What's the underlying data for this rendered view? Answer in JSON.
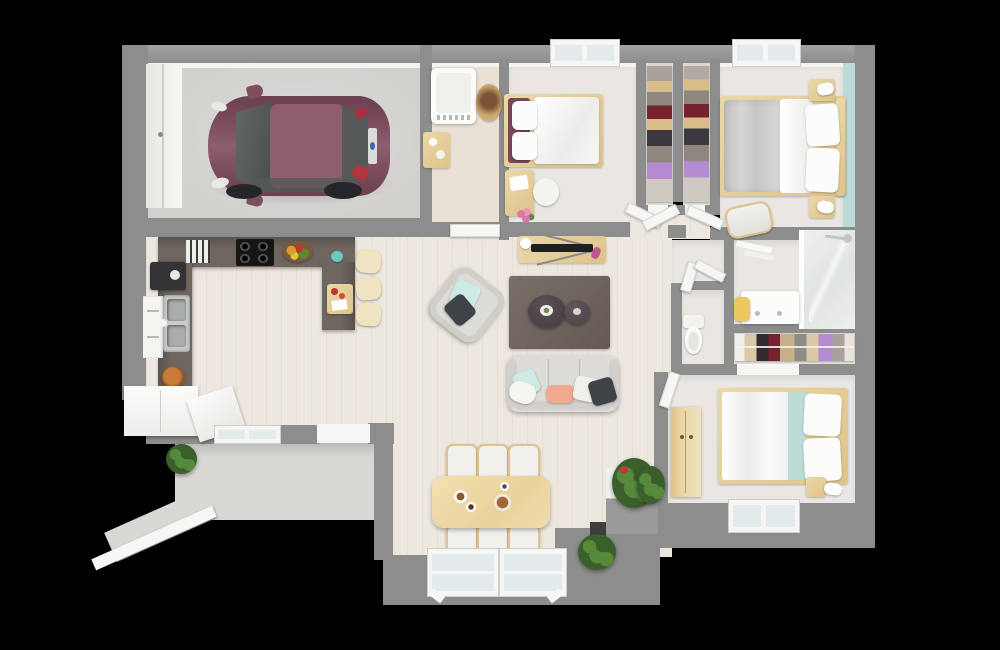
{
  "scene": {
    "title": "3D top-down floor plan render of a single-story house",
    "view": "overhead 3D render on black background"
  },
  "palette": {
    "wall": "#8d8d8d",
    "wall_light": "#a2a2a2",
    "wall_face": "#f3f3f1",
    "floor_wood": "#ece7df",
    "floor_light": "#eae7e2",
    "floor_laundry": "#e9e1d4",
    "concrete": "#d2d1ce",
    "porch": "#d9d8d4",
    "counter": "#6f6660",
    "counter_dark": "#5a524d",
    "wood": "#ead7a9",
    "wood_mid": "#dfc38a",
    "car_body": "#7d4e5e",
    "car_roof": "#8d5e6d",
    "car_glass": "#545a58",
    "rug": "#6e645d",
    "table_dark": "#4a4147",
    "sofa": "#dedcd8",
    "teal": "#bcdad6",
    "pillow_teal": "#cdeae4",
    "coral": "#f2a88d",
    "charcoal": "#3f4347",
    "green": "#558a3c",
    "green_dark": "#3a5f2b",
    "white": "#f6f6f4",
    "glass_blue": "#e3ebec",
    "clothes_red": "#76222e",
    "clothes_purple": "#b48bd0",
    "yellow": "#ecc95c",
    "pink": "#d978a8",
    "steel": "#c9cbc9",
    "tv_black": "#1d1f22",
    "basket_orange": "#c97a3a"
  },
  "rooms": {
    "garage": "Garage",
    "laundry": "Laundry room",
    "bedroom1": "Bedroom 1",
    "closet": "Walk-in closet",
    "master_bedroom": "Master bedroom",
    "hallway": "Hallway",
    "wc": "Toilet room",
    "bathroom": "Bathroom",
    "linen_closet": "Wardrobe closet",
    "bedroom2": "Bedroom 2",
    "living_room": "Living room",
    "dining_area": "Dining area",
    "kitchen": "Kitchen",
    "porch": "Entry porch"
  },
  "furniture": {
    "car": "Hatchback car",
    "garage_door": "Garage door",
    "washing_machine": "Washing machine",
    "laundry_basket": "Laundry basket",
    "laundry_table": "Side table",
    "bed1": "Single bed",
    "desk": "Desk",
    "desk_chair": "Desk chair",
    "closet_rack": "Clothes rack",
    "master_bed": "Double bed",
    "nightstand": "Nightstand with lamp",
    "bedroom_chair": "Chair",
    "toilet": "Toilet",
    "vanity": "Bathroom vanity",
    "vanity_stool": "Stool",
    "shower": "Walk-in shower",
    "clothes_rail": "Clothes rail",
    "bed2": "Double bed",
    "wardrobe": "Wardrobe",
    "tv_console": "TV stand with television",
    "rug": "Area rug",
    "coffee_table_large": "Round coffee table",
    "coffee_table_small": "Round side table",
    "armchair": "Armchair",
    "sofa": "Three-seat sofa",
    "dining_table": "Dining table",
    "dining_chair": "Dining chair",
    "kitchen_counter": "Kitchen counter",
    "cooktop": "Cooktop",
    "sink": "Double sink",
    "coffee_machine": "Coffee machine",
    "fruit_bowl": "Fruit bowl",
    "bread_basket": "Bread basket",
    "cutting_board": "Cutting board",
    "bar_stool": "Bar stool",
    "cabinets": "White cabinets",
    "dishwasher": "Dishwasher",
    "plant": "Potted plant",
    "bush": "Shrub",
    "window": "Window",
    "french_door": "French door",
    "entry_door": "Entry door",
    "interior_door": "Open interior door",
    "porch_railing": "Porch railing",
    "walkway": "Entry walkway"
  }
}
